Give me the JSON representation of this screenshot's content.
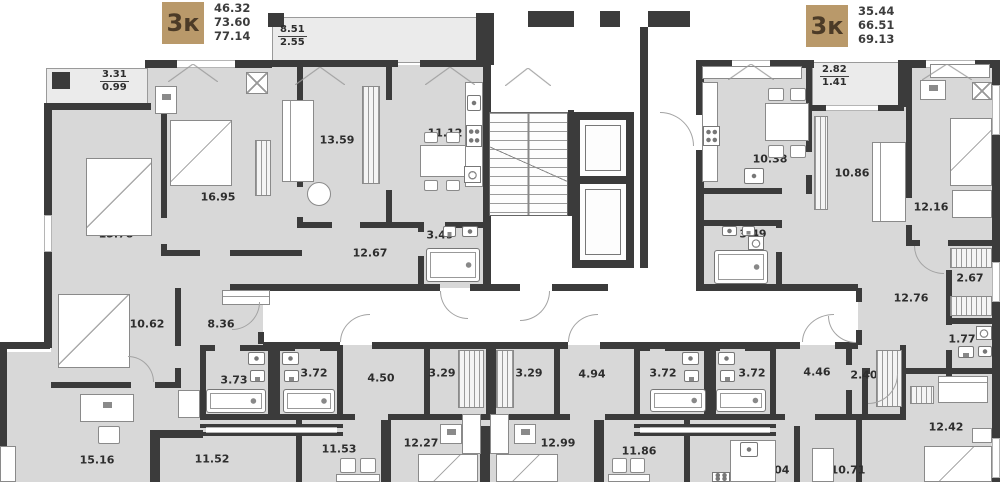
{
  "plan": {
    "left_apartment_card": {
      "type": "3к",
      "living_area": "46.32",
      "area": "73.60",
      "total_area": "77.14"
    },
    "right_apartment_card": {
      "type": "3к",
      "living_area": "35.44",
      "area": "66.51",
      "total_area": "69.13"
    },
    "balconies": {
      "top_left": {
        "area": "3.31",
        "reduced": "0.99"
      },
      "top_center": {
        "area": "8.51",
        "reduced": "2.55"
      },
      "top_right": {
        "area": "2.82",
        "reduced": "1.41"
      }
    },
    "rooms": {
      "tl_bedroom_1": "15.78",
      "tl_bedroom_2": "16.95",
      "tl_living": "13.59",
      "tl_kitchen": "11.12",
      "tl_bath": "3.49",
      "tl_hall": "12.67",
      "tr_kitchen": "10.38",
      "tr_living": "10.86",
      "tr_bedroom": "12.16",
      "tr_bath": "3.49",
      "tr_hall": "12.76",
      "tr_wardrobe": "2.67",
      "tr_wc": "1.77",
      "tr_room": "12.42",
      "bl_bedroom": "10.62",
      "bl_hall": "8.36",
      "bl_room_1": "15.16",
      "bl_room_2": "11.52",
      "bm_bath_1": "3.73",
      "bm_bath_2": "3.72",
      "bm_hall_1": "4.50",
      "bm_wardrobe_1": "3.29",
      "bm_wardrobe_2": "3.29",
      "bm_hall_2": "4.94",
      "bm_bath_3": "3.72",
      "bm_bath_4": "3.72",
      "bm_hall_3": "4.46",
      "bm_wardrobe_3": "2.40",
      "bm_room_1": "11.53",
      "bm_room_2": "12.27",
      "bm_room_3": "12.99",
      "bm_room_4": "11.86",
      "bm_kitchen": "11.04",
      "bm_room_5": "10.71"
    },
    "colors": {
      "badge_bg": "#b9996a",
      "badge_text": "#4c3b27",
      "wall": "#3b3b3b",
      "room_fill": "#d8d8d8",
      "balcony_fill": "#ebebeb",
      "label_text": "#2d2d2d"
    }
  }
}
